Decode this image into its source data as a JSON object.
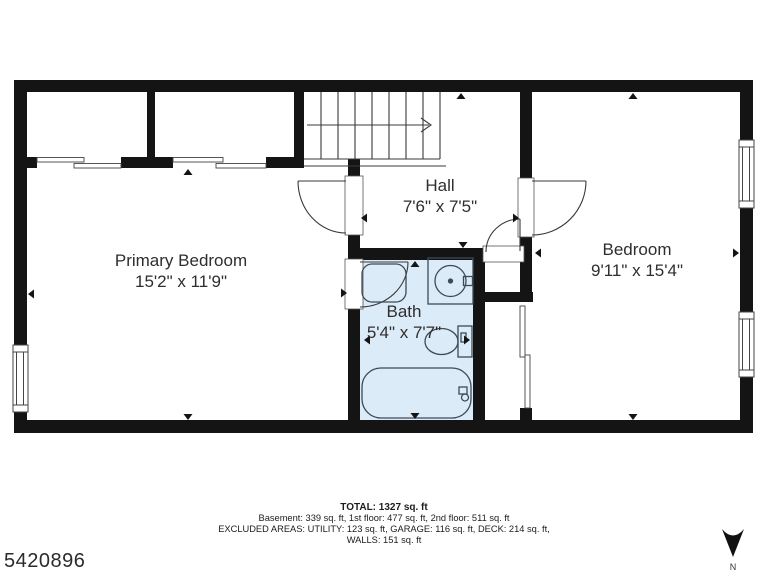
{
  "plan_id": "5420896",
  "compass": {
    "label": "N"
  },
  "rooms": {
    "primary": {
      "name": "Primary Bedroom",
      "dims": "15'2\" x 11'9\""
    },
    "hall": {
      "name": "Hall",
      "dims": "7'6\" x 7'5\""
    },
    "bath": {
      "name": "Bath",
      "dims": "5'4\" x 7'7\""
    },
    "bedroom": {
      "name": "Bedroom",
      "dims": "9'11\" x 15'4\""
    }
  },
  "summary": {
    "total": "TOTAL: 1327 sq. ft",
    "floors": "Basement: 339 sq. ft, 1st floor: 477 sq. ft, 2nd floor: 511 sq. ft",
    "excluded": "EXCLUDED AREAS: UTILITY: 123 sq. ft, GARAGE: 116 sq. ft, DECK: 214 sq. ft,",
    "walls": "WALLS: 151 sq. ft"
  },
  "colors": {
    "wall": "#141414",
    "bath_floor": "#dcebf8",
    "fixture_outline": "#3e4b57",
    "line": "#3a3a3a"
  }
}
